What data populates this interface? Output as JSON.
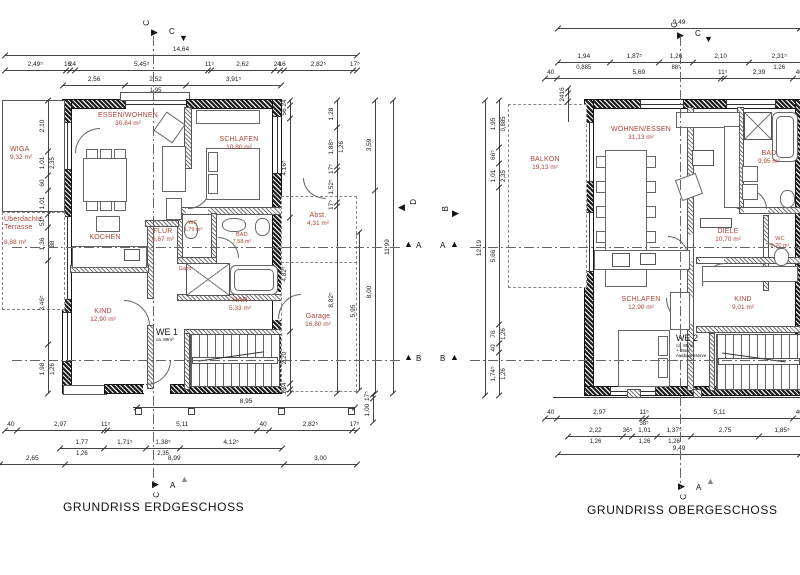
{
  "colors": {
    "room_label": "#a9443a",
    "line": "#444444",
    "wall": "#1a1a1a"
  },
  "icons": {
    "tri_right": "▶",
    "tri_left": "◀",
    "tri_up": "▲",
    "tri_down": "▼"
  },
  "markers": {
    "a": "A",
    "b": "B",
    "c": "C",
    "d": "D"
  },
  "plans": {
    "eg": {
      "title": "GRUNDRISS ERDGESCHOSS",
      "unit": {
        "label": "WE 1",
        "sub": "ca. 89m²"
      },
      "rooms": {
        "wiga": {
          "name": "WIGA",
          "area": "9,32 m²"
        },
        "terrasse": {
          "name": "Überdachte",
          "name2": "Terrasse",
          "area": "8,88 m²"
        },
        "essen": {
          "name": "ESSEN/WOHNEN",
          "area": "30,64 m²"
        },
        "schlafen": {
          "name": "SCHLAFEN",
          "area": "10,80 m²"
        },
        "kochen": {
          "name": "KOCHEN"
        },
        "wc": {
          "name": "WC",
          "area": "1,79 m²"
        },
        "bad": {
          "name": "BAD",
          "area": "7,58 m²"
        },
        "abst": {
          "name": "Abst.",
          "area": "4,31 m²"
        },
        "flur": {
          "name": "FLUR",
          "area": "6,67 m²"
        },
        "gard": {
          "name": "Gard."
        },
        "har": {
          "name": "HAR",
          "area": "5,33 m²"
        },
        "kind": {
          "name": "KIND",
          "area": "12,90 m²"
        },
        "garage": {
          "name": "Garage",
          "area": "16,80 m²"
        }
      },
      "dims": {
        "top_overall": [
          {
            "t": "14,64"
          }
        ],
        "top_row1": [
          {
            "t": "2,49⁵"
          },
          {
            "t": "16"
          },
          {
            "t": "24"
          },
          {
            "t": "5,45⁵"
          },
          {
            "t": "11⁵"
          },
          {
            "t": "2,62"
          },
          {
            "t": "24"
          },
          {
            "t": "16"
          },
          {
            "t": "2,82⁵"
          },
          {
            "t": "17⁵"
          }
        ],
        "top_row2": [
          {
            "t": "2,56"
          },
          {
            "t": "2,52",
            "s": "1,95"
          },
          {
            "t": "3,91⁵"
          }
        ],
        "bottom_width": [
          {
            "t": "8,95"
          }
        ],
        "bottom_row1": [
          {
            "t": "40"
          },
          {
            "t": "2,97"
          },
          {
            "t": "11⁵"
          },
          {
            "t": "5,11"
          },
          {
            "t": "40"
          },
          {
            "t": "2,82⁵"
          },
          {
            "t": "17⁵"
          }
        ],
        "bottom_row2": [
          {
            "t": "1,77",
            "s": "1,26"
          },
          {
            "t": "1,71⁵"
          },
          {
            "t": "1,38⁵",
            "s": "2,35"
          },
          {
            "t": "4,12⁵"
          }
        ],
        "bottom_row3": [
          {
            "t": "2,65"
          },
          {
            "t": "8,99"
          },
          {
            "t": "3,00"
          }
        ],
        "left_col": [
          {
            "t": "2,10"
          },
          {
            "t": "1,01",
            "s": "2,35"
          },
          {
            "t": "60"
          },
          {
            "t": "1,01"
          },
          {
            "t": "51⁵"
          },
          {
            "t": "1,36",
            "s": "88"
          },
          {
            "t": "3,46⁵"
          },
          {
            "t": "1,98",
            "s": "1,26"
          }
        ],
        "right_col1": [
          {
            "t": "24"
          },
          {
            "t": "56"
          },
          {
            "t": "4,16⁵"
          },
          {
            "t": "4,82⁵"
          },
          {
            "t": "2,20"
          },
          {
            "t": "24"
          },
          {
            "t": "16"
          }
        ],
        "right_col2": [
          {
            "t": "1,28"
          },
          {
            "t": "1,88⁵",
            "s": "1,26"
          },
          {
            "t": "17⁵"
          },
          {
            "t": "1,52⁵"
          },
          {
            "t": "17⁵"
          },
          {
            "t": "8,82⁵"
          }
        ],
        "right_col3": [
          {
            "t": "3,59"
          },
          {
            "t": "8,00"
          }
        ],
        "right_col4": [
          {
            "t": "5,95"
          }
        ],
        "right_col5": [
          {
            "t": "17⁵"
          },
          {
            "t": "1,00"
          }
        ],
        "right_overall": [
          {
            "t": "11,99"
          }
        ]
      }
    },
    "og": {
      "title": "GRUNDRISS OBERGESCHOSS",
      "unit": {
        "label": "WE 2",
        "sub1": "ca. 85m²",
        "sub2": "+ 45m²",
        "sub3": "Ausbaureserve"
      },
      "rooms": {
        "balkon": {
          "name": "BALKON",
          "area": "19,13 m²"
        },
        "wohnen": {
          "name": "WOHNEN/ESSEN",
          "area": "31,13 m²"
        },
        "bad": {
          "name": "BAD",
          "area": "9,95 m²"
        },
        "diele": {
          "name": "DIELE",
          "area": "10,70 m²"
        },
        "wc": {
          "name": "WC",
          "area": "2,20 m²"
        },
        "schlafen": {
          "name": "SCHLAFEN",
          "area": "12,90 m²"
        },
        "kind": {
          "name": "KIND",
          "area": "9,01 m²"
        }
      },
      "dims": {
        "top_overall": [
          {
            "t": "9,49"
          }
        ],
        "top_row1": [
          {
            "t": "1,94",
            "s": "0,885"
          },
          {
            "t": "1,87⁵"
          },
          {
            "t": "1,26",
            "s": "88⁵"
          },
          {
            "t": "2,10"
          },
          {
            "t": "2,31⁵",
            "s": "1,26"
          }
        ],
        "top_row2": [
          {
            "t": "40"
          },
          {
            "t": "5,69"
          },
          {
            "t": "11⁵"
          },
          {
            "t": "2,39"
          },
          {
            "t": "40"
          }
        ],
        "bottom_row1": [
          {
            "t": "40"
          },
          {
            "t": "2,97"
          },
          {
            "t": "11⁵",
            "s": "38⁵"
          },
          {
            "t": "5,11"
          },
          {
            "t": "40"
          }
        ],
        "bottom_row2": [
          {
            "t": "2,22",
            "s": "1,26"
          },
          {
            "t": "36⁵"
          },
          {
            "t": "1,01",
            "s": "1,26"
          },
          {
            "t": "1,37⁵",
            "s": "1,26"
          },
          {
            "t": "2,75"
          },
          {
            "t": "1,85⁵"
          }
        ],
        "bottom_overall": [
          {
            "t": "9,49"
          }
        ],
        "left_col1": [
          {
            "t": "16"
          },
          {
            "t": "24"
          }
        ],
        "left_col2": [
          {
            "t": "1,95",
            "s": "0,885"
          },
          {
            "t": "66⁵"
          },
          {
            "t": "1,01",
            "s": "2,35"
          },
          {
            "t": "5,66"
          },
          {
            "t": "76",
            "s": "1,26"
          },
          {
            "t": "40"
          },
          {
            "t": "1,74⁵",
            "s": "1,26"
          }
        ],
        "left_overall": [
          {
            "t": "12,19"
          }
        ]
      }
    }
  }
}
